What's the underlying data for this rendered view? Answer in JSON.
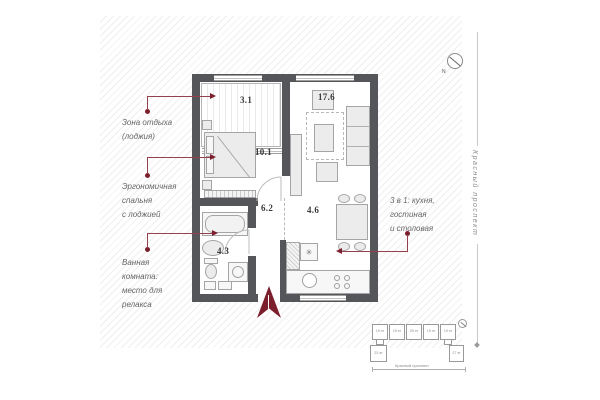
{
  "title": "apartment-floor-plan",
  "colors": {
    "wall": "#54565a",
    "accent_maroon": "#7c1f2d",
    "callout_line": "#96404e",
    "hatch_line": "#efefef",
    "furniture_border": "#a5a5a5",
    "note_text": "#666666"
  },
  "plan": {
    "rooms": [
      {
        "name": "loggia",
        "area": "3.1"
      },
      {
        "name": "living-room",
        "area": "17.6"
      },
      {
        "name": "bedroom",
        "area": "10.1"
      },
      {
        "name": "hallway",
        "area": "6.2"
      },
      {
        "name": "kitchen-dining",
        "area": "4.6"
      },
      {
        "name": "bathroom",
        "area": "4.3"
      }
    ]
  },
  "callouts": [
    {
      "target": "loggia",
      "lines": [
        "Зона отдыха",
        "(лоджия)"
      ]
    },
    {
      "target": "bedroom",
      "lines": [
        "Эргономичная",
        "спальня",
        "с лоджией"
      ]
    },
    {
      "target": "bathroom",
      "lines": [
        "Ванная",
        "комната:",
        "место для",
        "релакса"
      ]
    },
    {
      "target": "kitchen-living",
      "lines": [
        "3 в 1: кухня,",
        "гостиная",
        "и столовая"
      ]
    }
  ],
  "street_label_vertical": "Красный проспект",
  "compass": {
    "north_label": "N"
  },
  "icons": {
    "fridge_snowflake": "✳"
  },
  "site_plan": {
    "blocks_top": [
      "19 эт",
      "19 эт",
      "25 эт",
      "19 эт",
      "19 эт"
    ],
    "blocks_bottom": [
      "23 эт",
      "27 эт"
    ],
    "street_label": "Красный проспект"
  }
}
